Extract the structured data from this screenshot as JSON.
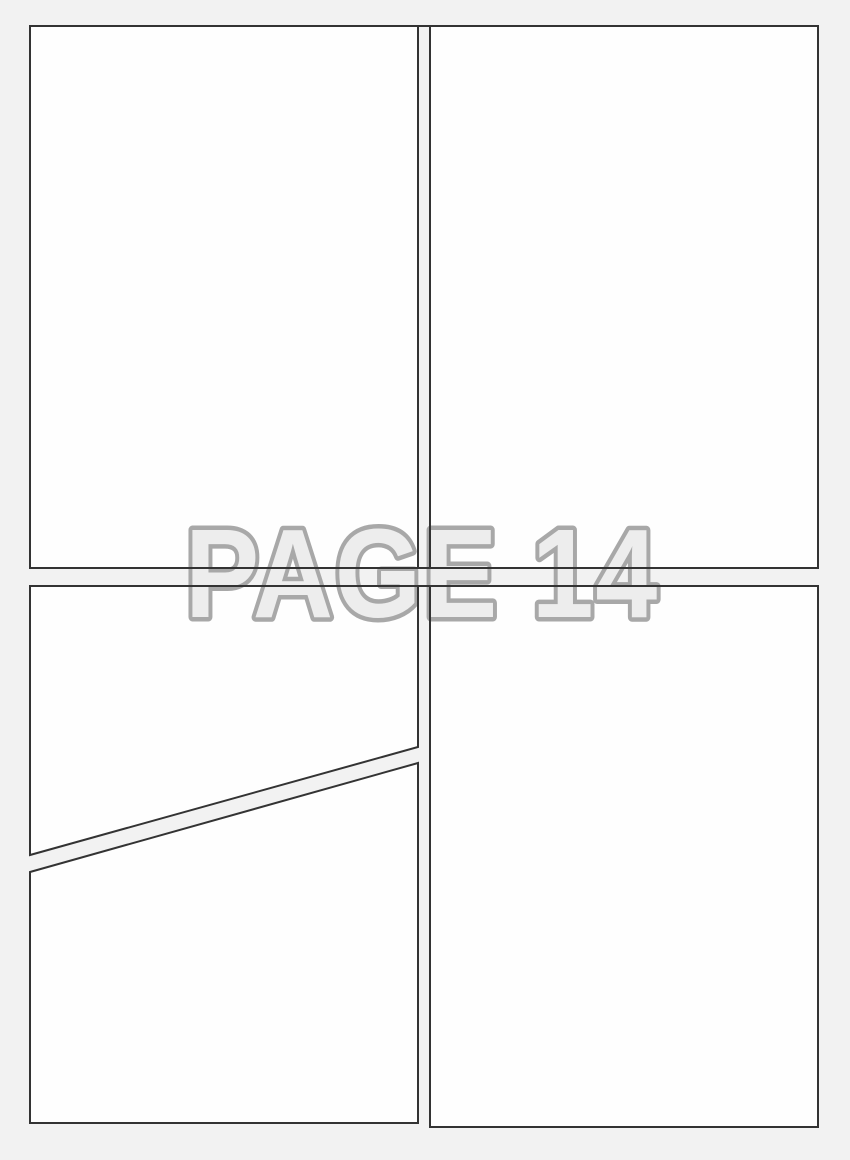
{
  "watermark": {
    "text": "PAGE 14",
    "page_number": "14"
  },
  "colors": {
    "page_background": "#f2f2f2",
    "panel_fill": "#fefefe",
    "panel_border": "#333333",
    "watermark_fill": "#ededed",
    "watermark_outline": "#a8a8a8"
  },
  "layout": {
    "panel_count": 5,
    "panels": [
      "top-left",
      "top-right",
      "bottom-left-upper-diagonal",
      "bottom-left-lower-diagonal",
      "bottom-right"
    ]
  }
}
